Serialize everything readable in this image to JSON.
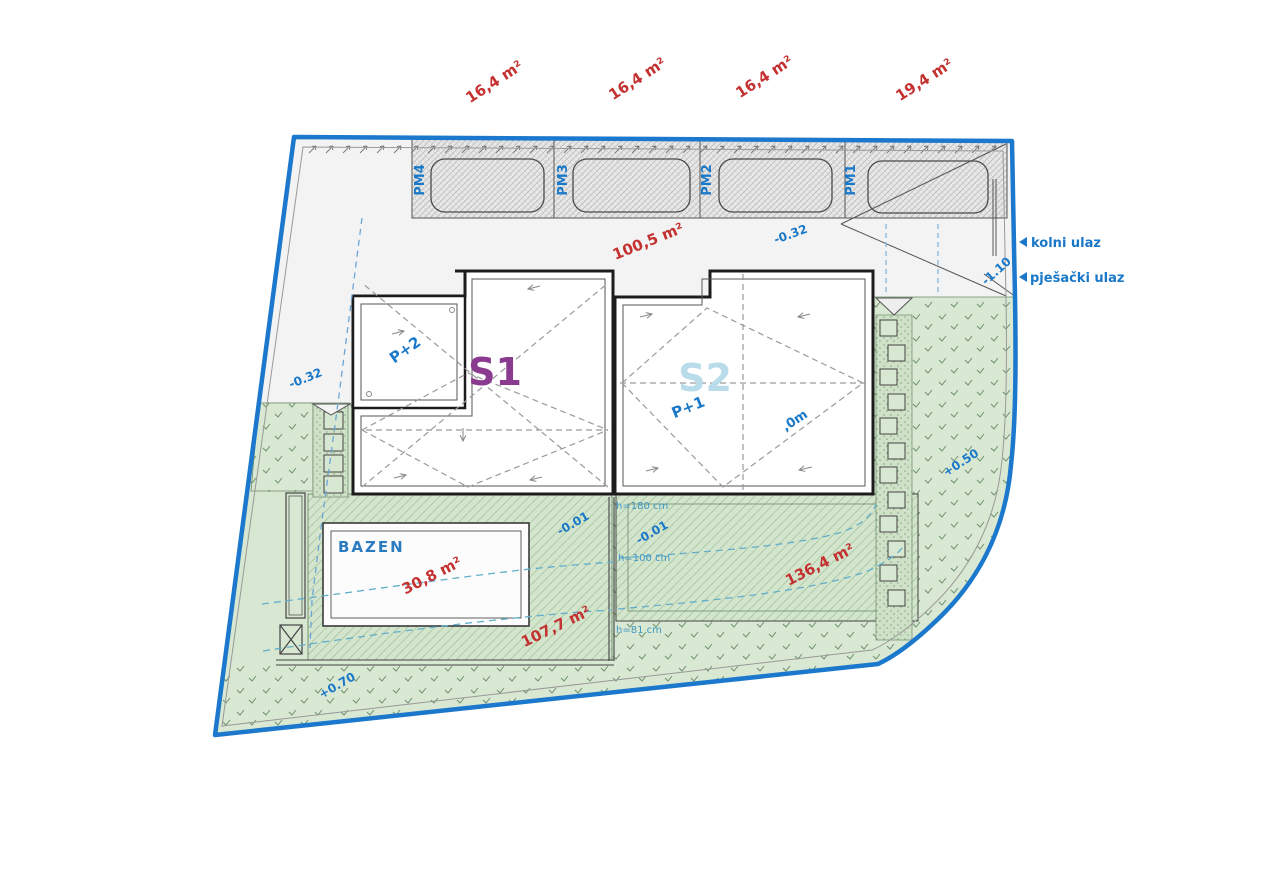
{
  "site_plan": {
    "colors": {
      "boundary": "#1b78cc",
      "red_label": "#c43131",
      "blue_label": "#1a78c8",
      "s1_name": "#8a3b8f",
      "s2_name": "#b9dcea",
      "teal_contour": "#62aeca",
      "bazen_label": "#2b7bc0",
      "height_label": "#3d96c4"
    },
    "parking": {
      "stalls": [
        {
          "id": "PM4",
          "area": "16,4 m²"
        },
        {
          "id": "PM3",
          "area": "16,4 m²"
        },
        {
          "id": "PM2",
          "area": "16,4 m²"
        },
        {
          "id": "PM1",
          "area": "19,4 m²"
        }
      ]
    },
    "paved": {
      "area": "100,5 m²",
      "elevation": "-0.32"
    },
    "buildings": [
      {
        "name": "S1",
        "floors": "P+2"
      },
      {
        "name": "S2",
        "floors": "P+1",
        "ridge_label": ",0m"
      }
    ],
    "pool": {
      "label": "BAZEN",
      "area": "30,8 m²"
    },
    "terraces": {
      "pool_terrace_area": "107,7 m²",
      "right_terrace_area": "136,4 m²",
      "elevation": "-0.01"
    },
    "garden": {
      "right_elevation": "+0.50",
      "bottom_elevation": "+0.70"
    },
    "walls": {
      "h1": "h=180 cm",
      "h2": "h=100 cm",
      "h3": "h=81 cm"
    },
    "entrances": {
      "vehicle": "kolni ulaz",
      "pedestrian": "pješački ulaz",
      "elevation": "-1.10"
    }
  }
}
